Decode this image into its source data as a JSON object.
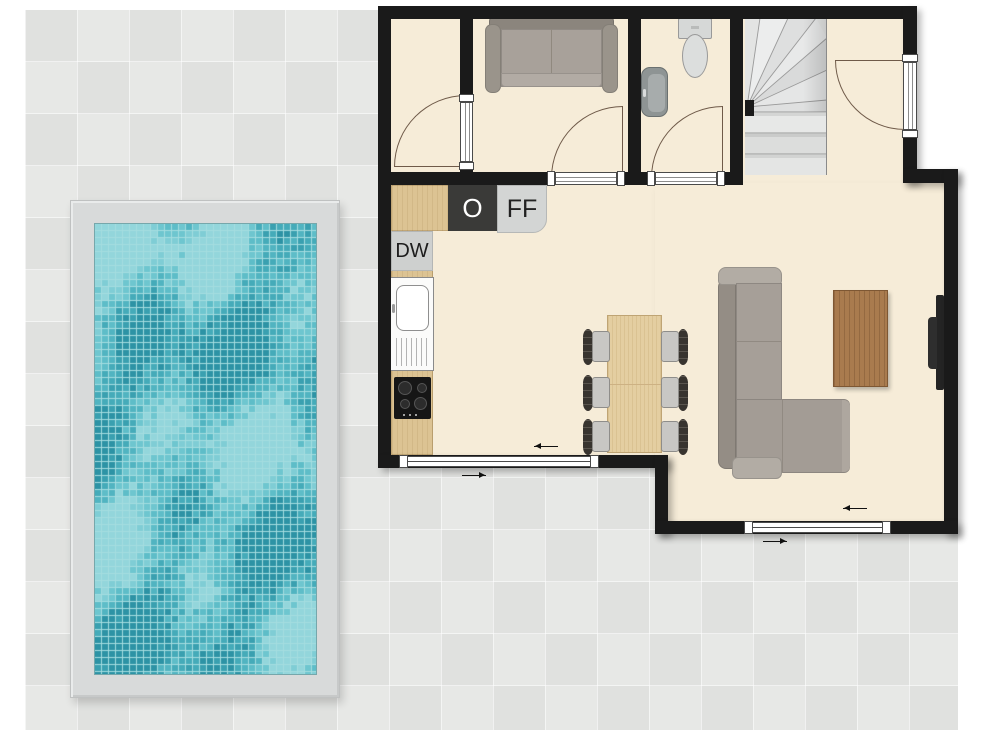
{
  "floorplan": {
    "appliance_labels": {
      "oven": "O",
      "fridge_freezer": "FF",
      "dishwasher": "DW"
    },
    "colors": {
      "wall": "#1a1a1a",
      "interior_floor": "#f6ecd8",
      "patio_tile": "#e3e4e2",
      "counter_wood": "#dcc393",
      "oven_unit": "#3a3a38",
      "fridge_unit": "#d3d5d4",
      "dishwasher_unit": "#ced0cf",
      "sofa_gray": "#a59e97",
      "coffee_table_wood": "#a97b4e",
      "stair_gray": "#e4e5e4",
      "pool_deck": "#d8dada",
      "door_swing": "#6f5a49"
    },
    "pool": {
      "cell": 7,
      "grout": "#a5dde0",
      "palette": [
        "#2d93a5",
        "#3aa0b0",
        "#45abb9",
        "#51b4c1",
        "#5ebdc8",
        "#6ec6cf",
        "#7fcdd5",
        "#93d6db"
      ]
    },
    "semantics": {
      "rooms": [
        "hall",
        "lounge-bedroom",
        "bathroom",
        "stair-hall",
        "kitchen-diner",
        "living-room",
        "patio"
      ],
      "furniture": [
        "loveseat",
        "toilet",
        "wash-basin",
        "winder-staircase",
        "oven",
        "fridge-freezer",
        "dishwasher",
        "sink-drainer",
        "hob",
        "dining-table",
        "dining-chair",
        "corner-sofa",
        "coffee-table",
        "tv",
        "swimming-pool"
      ]
    }
  }
}
